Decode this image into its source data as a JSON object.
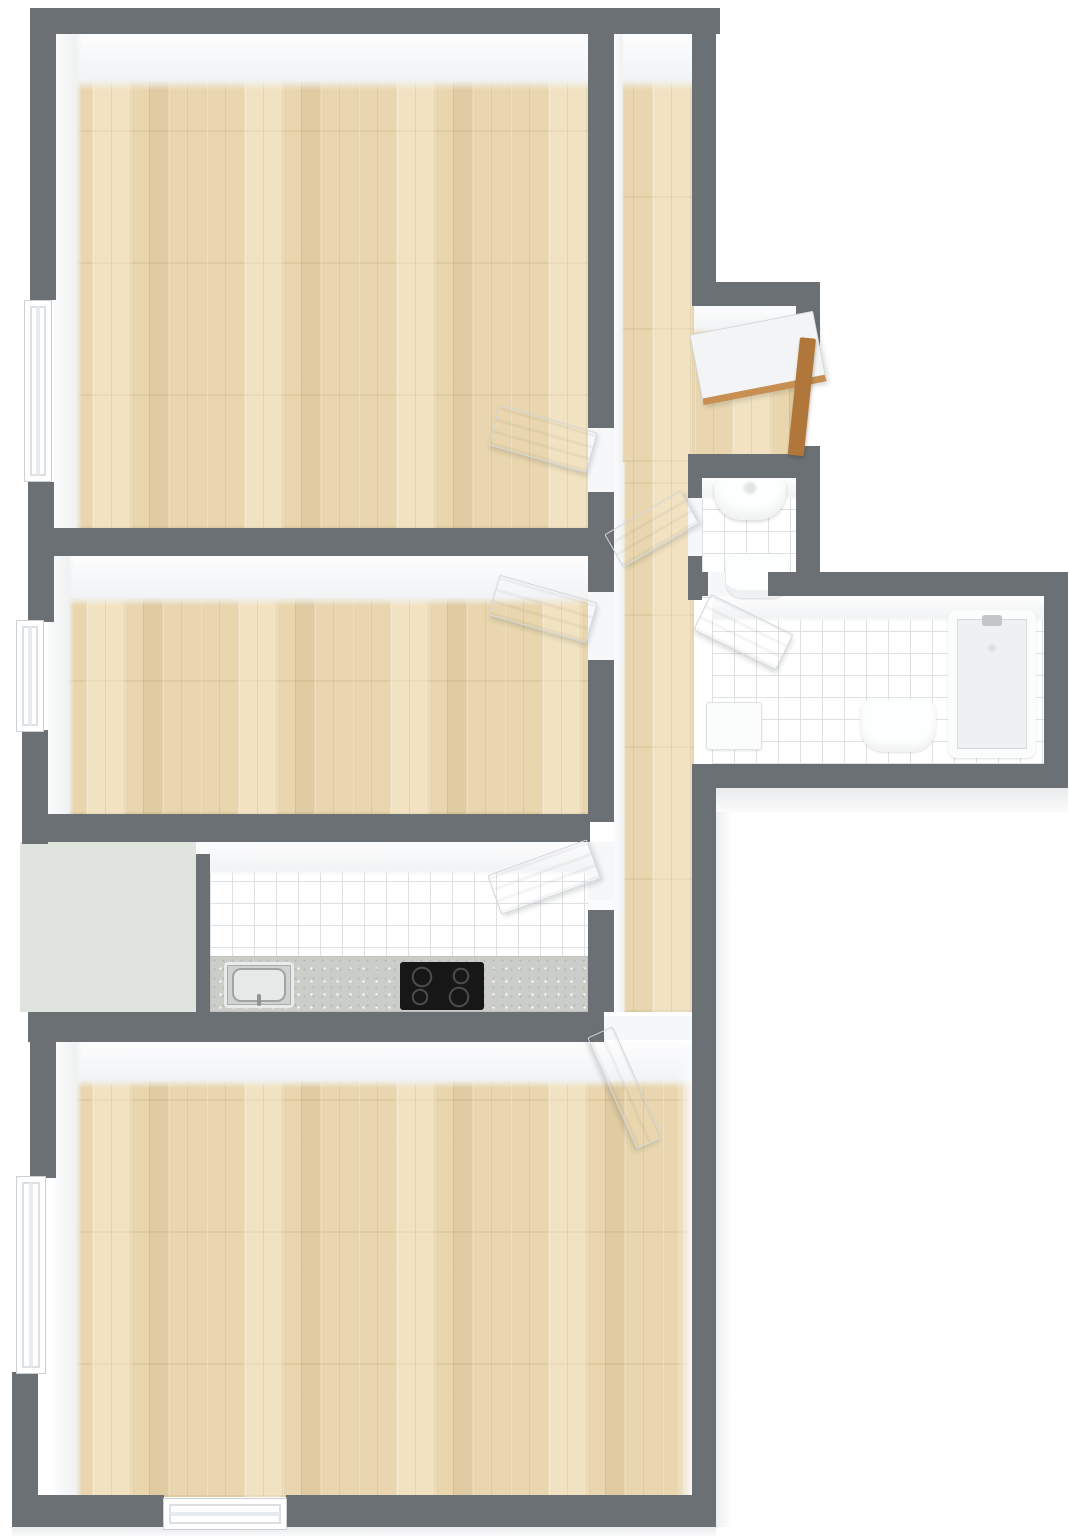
{
  "canvas": {
    "w": 1069,
    "h": 1536
  },
  "palette": {
    "background": "#ffffff",
    "wall_gray": "#6a7074",
    "wall_face_white": "#f1f3f4",
    "wood_floor": "#e9d6ae",
    "tile_white": "#ffffff",
    "tile_grout": "#dde1e4",
    "counter_granite": "#cbcdc9",
    "cooktop_black": "#171717",
    "balcony_floor": "#e0e4de",
    "entry_door_wood": "#b0763a",
    "door_white": "#f6f7f8"
  },
  "rooms": [
    {
      "name": "bedroom-top",
      "floor": "wood",
      "openings": [
        "window-left",
        "door-to-corridor"
      ]
    },
    {
      "name": "bedroom-middle",
      "floor": "wood",
      "openings": [
        "window-left",
        "door-to-corridor"
      ]
    },
    {
      "name": "hallway-entry",
      "floor": "wood",
      "openings": [
        "entry-door-open"
      ]
    },
    {
      "name": "corridor",
      "floor": "wood",
      "openings": [
        "doors-to-all-rooms"
      ]
    },
    {
      "name": "kitchen",
      "floor": "white-tile",
      "fixtures": [
        "granite-counter",
        "steel-sink",
        "cooktop-4-burners"
      ]
    },
    {
      "name": "balcony-storage",
      "floor": "pale-green"
    },
    {
      "name": "wc",
      "floor": "white-tile",
      "fixtures": [
        "washbasin",
        "toilet"
      ]
    },
    {
      "name": "bathroom",
      "floor": "white-tile",
      "fixtures": [
        "bathtub",
        "washbasin",
        "washing-machine"
      ]
    },
    {
      "name": "living-room",
      "floor": "wood",
      "openings": [
        "window-left",
        "window-bottom",
        "door-to-corridor"
      ]
    }
  ],
  "elements": [
    {
      "n": "bedroom-top-floor",
      "k": "floor",
      "c": "wood",
      "x": 54,
      "y": 34,
      "w": 536,
      "h": 494
    },
    {
      "n": "hallway-floor",
      "k": "floor",
      "c": "wood",
      "x": 614,
      "y": 34,
      "w": 80,
      "h": 428
    },
    {
      "n": "entry-nook-floor",
      "k": "floor",
      "c": "wood",
      "x": 694,
      "y": 306,
      "w": 102,
      "h": 156
    },
    {
      "n": "corridor-floor",
      "k": "floor",
      "c": "wood",
      "x": 614,
      "y": 462,
      "w": 80,
      "h": 550
    },
    {
      "n": "bedroom-middle-floor",
      "k": "floor",
      "c": "wood",
      "x": 48,
      "y": 556,
      "w": 542,
      "h": 258
    },
    {
      "n": "kitchen-floor",
      "k": "floor",
      "c": "tile",
      "x": 210,
      "y": 842,
      "w": 378,
      "h": 172
    },
    {
      "n": "balcony-floor",
      "k": "floor",
      "c": "balcony",
      "x": 20,
      "y": 842,
      "w": 176,
      "h": 170
    },
    {
      "n": "living-room-floor",
      "k": "floor",
      "c": "wood",
      "x": 54,
      "y": 1042,
      "w": 638,
      "h": 455
    },
    {
      "n": "wc-floor",
      "k": "floor",
      "c": "tile",
      "x": 702,
      "y": 478,
      "w": 94,
      "h": 120
    },
    {
      "n": "bathroom-floor",
      "k": "floor",
      "c": "tile",
      "x": 712,
      "y": 596,
      "w": 332,
      "h": 168
    },
    {
      "n": "bedroom-top-wallface-top",
      "k": "face",
      "c": "face-top",
      "x": 54,
      "y": 34,
      "w": 536,
      "h": 56
    },
    {
      "n": "bedroom-top-wallface-left",
      "k": "face",
      "c": "face-left",
      "x": 54,
      "y": 34,
      "w": 28,
      "h": 494
    },
    {
      "n": "hallway-wallface-top",
      "k": "face",
      "c": "face-top",
      "x": 614,
      "y": 34,
      "w": 80,
      "h": 56
    },
    {
      "n": "hallway-wallface-left",
      "k": "face",
      "c": "face-left",
      "x": 614,
      "y": 34,
      "w": 10,
      "h": 428
    },
    {
      "n": "entry-nook-wallface-top",
      "k": "face",
      "c": "face-top",
      "x": 694,
      "y": 306,
      "w": 102,
      "h": 28
    },
    {
      "n": "bedroom-middle-wallface-top",
      "k": "face",
      "c": "face-top",
      "x": 48,
      "y": 556,
      "w": 542,
      "h": 50
    },
    {
      "n": "bedroom-middle-wallface-left",
      "k": "face",
      "c": "face-left",
      "x": 48,
      "y": 556,
      "w": 26,
      "h": 258
    },
    {
      "n": "kitchen-wallface-top",
      "k": "face",
      "c": "face-top",
      "x": 210,
      "y": 842,
      "w": 378,
      "h": 34
    },
    {
      "n": "living-wallface-top",
      "k": "face",
      "c": "face-top",
      "x": 54,
      "y": 1042,
      "w": 638,
      "h": 46
    },
    {
      "n": "living-wallface-left",
      "k": "face",
      "c": "face-left",
      "x": 54,
      "y": 1042,
      "w": 28,
      "h": 455
    },
    {
      "n": "living-wallface-right",
      "k": "face",
      "c": "face-right",
      "x": 676,
      "y": 1042,
      "w": 16,
      "h": 455
    },
    {
      "n": "corridor-wallface-left",
      "k": "face",
      "c": "face-left",
      "x": 614,
      "y": 462,
      "w": 12,
      "h": 550
    },
    {
      "n": "wc-wallface-top",
      "k": "face",
      "c": "face-top",
      "x": 702,
      "y": 478,
      "w": 94,
      "h": 22
    },
    {
      "n": "bathroom-wallface-top",
      "k": "face",
      "c": "face-top",
      "x": 712,
      "y": 596,
      "w": 332,
      "h": 26
    },
    {
      "n": "divider-wall-cap",
      "k": "cap",
      "c": "cap",
      "x": 196,
      "y": 842,
      "w": 14,
      "h": 12
    },
    {
      "n": "corridor-wall-cap",
      "k": "cap",
      "c": "cap",
      "x": 588,
      "y": 900,
      "w": 26,
      "h": 10
    },
    {
      "n": "bathroom-outer-face-bottom",
      "k": "outer",
      "c": "outer-flat",
      "x": 716,
      "y": 788,
      "w": 352,
      "h": 24
    },
    {
      "n": "living-outer-face-right",
      "k": "outer",
      "c": "outer-side",
      "x": 716,
      "y": 812,
      "w": 16,
      "h": 715
    },
    {
      "n": "plan-outer-face-bottom",
      "k": "outer",
      "c": "outer-flat",
      "x": 12,
      "y": 1527,
      "w": 704,
      "h": 9
    },
    {
      "n": "threshold-bedroom-top",
      "k": "threshold",
      "c": "threshold",
      "x": 588,
      "y": 428,
      "w": 26,
      "h": 64
    },
    {
      "n": "threshold-bedroom-middle",
      "k": "threshold",
      "c": "threshold",
      "x": 588,
      "y": 592,
      "w": 26,
      "h": 68
    },
    {
      "n": "threshold-kitchen",
      "k": "threshold",
      "c": "threshold",
      "x": 588,
      "y": 842,
      "w": 26,
      "h": 66
    },
    {
      "n": "threshold-wc",
      "k": "threshold",
      "c": "threshold",
      "x": 688,
      "y": 498,
      "w": 14,
      "h": 58
    },
    {
      "n": "threshold-bathroom",
      "k": "threshold",
      "c": "threshold",
      "x": 708,
      "y": 572,
      "w": 60,
      "h": 24
    },
    {
      "n": "threshold-living",
      "k": "threshold",
      "c": "threshold",
      "x": 604,
      "y": 1016,
      "w": 88,
      "h": 24
    },
    {
      "n": "kitchen-counter",
      "k": "fixture",
      "c": "counter",
      "x": 210,
      "y": 956,
      "w": 378,
      "h": 56
    },
    {
      "n": "kitchen-sink",
      "k": "fixture",
      "c": "kitchen-sink",
      "x": 224,
      "y": 962,
      "w": 70,
      "h": 46
    },
    {
      "n": "cooktop",
      "k": "fixture",
      "c": "cooktop",
      "x": 400,
      "y": 962,
      "w": 84,
      "h": 48
    },
    {
      "n": "wc-washbasin",
      "k": "fixture",
      "c": "wc-sink",
      "x": 714,
      "y": 480,
      "w": 72,
      "h": 40
    },
    {
      "n": "toilet",
      "k": "fixture",
      "c": "toilet",
      "x": 726,
      "y": 554,
      "w": 62,
      "h": 44
    },
    {
      "n": "bathtub",
      "k": "fixture",
      "c": "tub",
      "x": 948,
      "y": 610,
      "w": 88,
      "h": 148
    },
    {
      "n": "bath-washbasin",
      "k": "fixture",
      "c": "basin",
      "x": 860,
      "y": 700,
      "w": 76,
      "h": 52
    },
    {
      "n": "washing-machine",
      "k": "fixture",
      "c": "washer",
      "x": 706,
      "y": 702,
      "w": 56,
      "h": 48
    },
    {
      "n": "wall-top",
      "k": "wall",
      "c": "wall",
      "x": 34,
      "y": 8,
      "w": 686,
      "h": 26
    },
    {
      "n": "wall-left-upper",
      "k": "wall",
      "c": "wall",
      "x": 30,
      "y": 8,
      "w": 26,
      "h": 292
    },
    {
      "n": "wall-left-mid",
      "k": "wall",
      "c": "wall",
      "x": 28,
      "y": 482,
      "w": 26,
      "h": 140
    },
    {
      "n": "wall-left-bedroom2",
      "k": "wall",
      "c": "wall",
      "x": 22,
      "y": 730,
      "w": 26,
      "h": 114
    },
    {
      "n": "wall-bedrooms-divider",
      "k": "wall",
      "c": "wall",
      "x": 30,
      "y": 528,
      "w": 560,
      "h": 28
    },
    {
      "n": "wall-bedroom2-kitchen",
      "k": "wall",
      "c": "wall",
      "x": 24,
      "y": 814,
      "w": 566,
      "h": 28
    },
    {
      "n": "wall-balcony-divider",
      "k": "wall",
      "c": "wall",
      "x": 196,
      "y": 842,
      "w": 14,
      "h": 170
    },
    {
      "n": "wall-living-top",
      "k": "wall",
      "c": "wall",
      "x": 28,
      "y": 1012,
      "w": 576,
      "h": 30
    },
    {
      "n": "wall-left-living-up",
      "k": "wall",
      "c": "wall",
      "x": 30,
      "y": 1012,
      "w": 26,
      "h": 166
    },
    {
      "n": "wall-left-living-low",
      "k": "wall",
      "c": "wall",
      "x": 12,
      "y": 1372,
      "w": 26,
      "h": 155
    },
    {
      "n": "wall-bottom-left",
      "k": "wall",
      "c": "wall",
      "x": 12,
      "y": 1495,
      "w": 152,
      "h": 32
    },
    {
      "n": "wall-bottom-right",
      "k": "wall",
      "c": "wall",
      "x": 286,
      "y": 1495,
      "w": 430,
      "h": 32
    },
    {
      "n": "wall-right-lower",
      "k": "wall",
      "c": "wall",
      "x": 692,
      "y": 782,
      "w": 24,
      "h": 745
    },
    {
      "n": "wall-corridor-a",
      "k": "wall",
      "c": "wall",
      "x": 588,
      "y": 8,
      "w": 26,
      "h": 420
    },
    {
      "n": "wall-corridor-b",
      "k": "wall",
      "c": "wall",
      "x": 588,
      "y": 492,
      "w": 26,
      "h": 100
    },
    {
      "n": "wall-corridor-c",
      "k": "wall",
      "c": "wall",
      "x": 588,
      "y": 660,
      "w": 26,
      "h": 162
    },
    {
      "n": "wall-corridor-d",
      "k": "wall",
      "c": "wall",
      "x": 588,
      "y": 908,
      "w": 26,
      "h": 104
    },
    {
      "n": "wall-right-hallway",
      "k": "wall",
      "c": "wall",
      "x": 692,
      "y": 8,
      "w": 24,
      "h": 280
    },
    {
      "n": "wall-entry-jog",
      "k": "wall",
      "c": "wall",
      "x": 692,
      "y": 282,
      "w": 128,
      "h": 24
    },
    {
      "n": "wall-entry-right-up",
      "k": "wall",
      "c": "wall",
      "x": 796,
      "y": 282,
      "w": 24,
      "h": 64
    },
    {
      "n": "wall-entry-right-low",
      "k": "wall",
      "c": "wall",
      "x": 796,
      "y": 446,
      "w": 24,
      "h": 32
    },
    {
      "n": "wall-wc-top",
      "k": "wall",
      "c": "wall",
      "x": 688,
      "y": 454,
      "w": 132,
      "h": 24
    },
    {
      "n": "wall-wc-left-a",
      "k": "wall",
      "c": "wall",
      "x": 688,
      "y": 454,
      "w": 14,
      "h": 44
    },
    {
      "n": "wall-wc-left-b",
      "k": "wall",
      "c": "wall",
      "x": 688,
      "y": 556,
      "w": 14,
      "h": 44
    },
    {
      "n": "wall-wc-right",
      "k": "wall",
      "c": "wall",
      "x": 796,
      "y": 454,
      "w": 24,
      "h": 142
    },
    {
      "n": "wall-bath-top",
      "k": "wall",
      "c": "wall",
      "x": 768,
      "y": 572,
      "w": 300,
      "h": 24
    },
    {
      "n": "wall-bath-top-stub",
      "k": "wall",
      "c": "wall",
      "x": 688,
      "y": 572,
      "w": 20,
      "h": 24
    },
    {
      "n": "wall-bath-right",
      "k": "wall",
      "c": "wall",
      "x": 1044,
      "y": 572,
      "w": 24,
      "h": 216
    },
    {
      "n": "wall-bath-bottom",
      "k": "wall",
      "c": "wall",
      "x": 692,
      "y": 764,
      "w": 376,
      "h": 24
    },
    {
      "n": "window-bedroom-top-left",
      "k": "window",
      "c": "window",
      "x": 24,
      "y": 300,
      "w": 28,
      "h": 182
    },
    {
      "n": "window-bedroom-middle-left",
      "k": "window",
      "c": "window",
      "x": 16,
      "y": 620,
      "w": 28,
      "h": 112
    },
    {
      "n": "window-living-left",
      "k": "window",
      "c": "window",
      "x": 16,
      "y": 1176,
      "w": 30,
      "h": 198
    },
    {
      "n": "window-living-bottom",
      "k": "window",
      "c": "window window-h",
      "x": 163,
      "y": 1498,
      "w": 124,
      "h": 32
    },
    {
      "n": "door-bedroom-top",
      "k": "door",
      "c": "door",
      "x": 490,
      "y": 432,
      "w": 102,
      "h": 42,
      "r": 16,
      "o": "100% 50%"
    },
    {
      "n": "door-bedroom-middle",
      "k": "door",
      "c": "door",
      "x": 490,
      "y": 602,
      "w": 102,
      "h": 42,
      "r": 16,
      "o": "100% 50%"
    },
    {
      "n": "door-kitchen",
      "k": "door",
      "c": "door",
      "x": 488,
      "y": 838,
      "w": 106,
      "h": 42,
      "r": -20,
      "o": "100% 50%"
    },
    {
      "n": "door-wc",
      "k": "door",
      "c": "door",
      "x": 602,
      "y": 488,
      "w": 88,
      "h": 38,
      "r": -30,
      "o": "100% 50%"
    },
    {
      "n": "door-bathroom",
      "k": "door",
      "c": "door",
      "x": 702,
      "y": 592,
      "w": 92,
      "h": 40,
      "r": 26,
      "o": "0% 50%"
    },
    {
      "n": "door-living-room",
      "k": "door",
      "c": "door",
      "x": 600,
      "y": 1018,
      "w": 122,
      "h": 28,
      "r": 66,
      "o": "0% 50%"
    },
    {
      "n": "entry-door-leaf",
      "k": "door",
      "c": "door entry-leaf",
      "x": 694,
      "y": 310,
      "w": 126,
      "h": 72,
      "r": -11,
      "o": "100% 50%"
    },
    {
      "n": "entry-door-frame",
      "k": "frame",
      "c": "frame",
      "x": 800,
      "y": 338,
      "w": 16,
      "h": 118,
      "r": 6,
      "o": "50% 0%"
    }
  ]
}
